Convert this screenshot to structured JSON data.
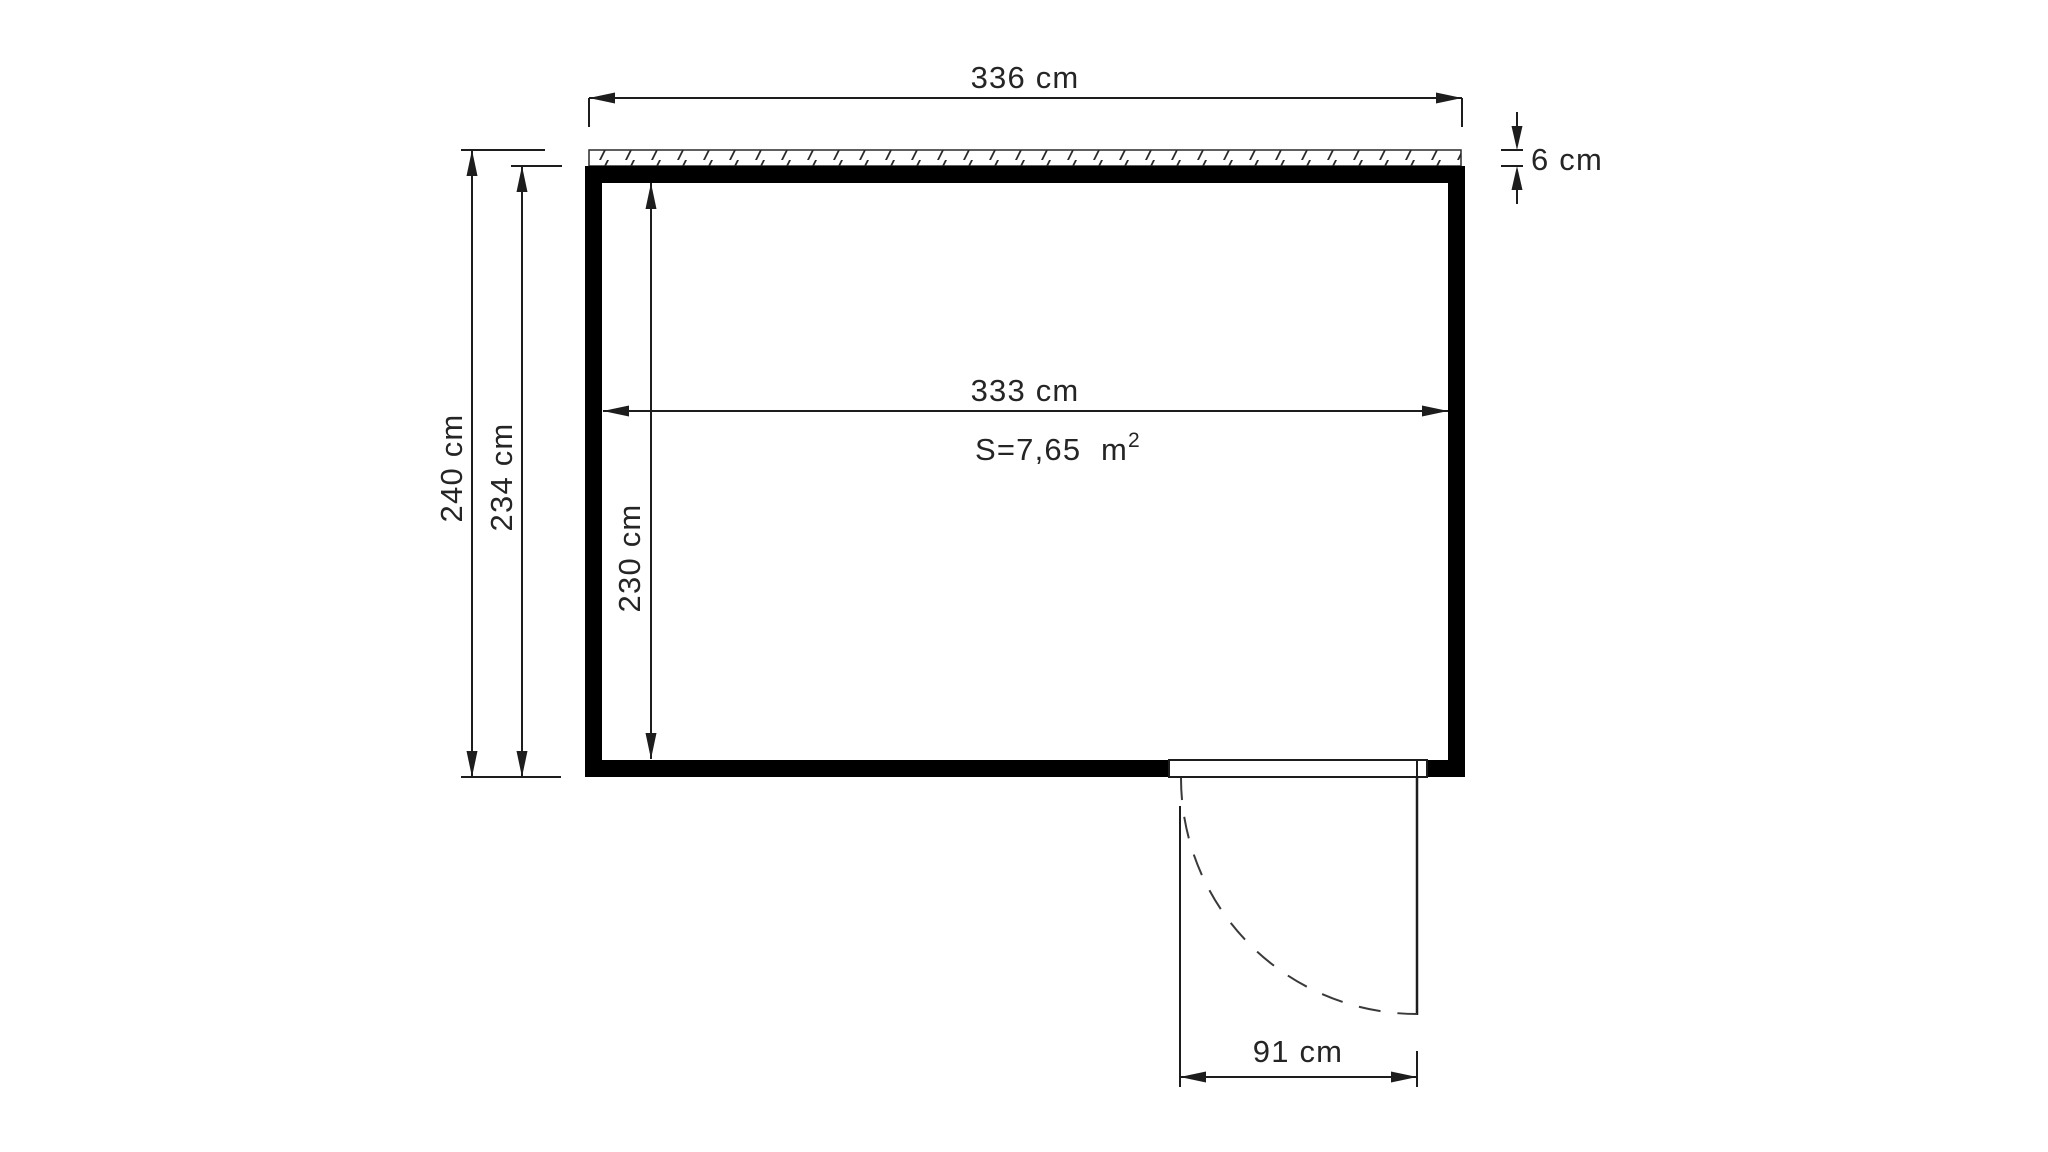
{
  "drawing": {
    "kind": "shed-floor-plan",
    "colors": {
      "background": "#ffffff",
      "line": "#1d1d1d",
      "wall": "#000000",
      "text": "#252525"
    },
    "labels": {
      "outer_width": "336 cm",
      "overhang_thickness": "6 cm",
      "outer_depth": "240 cm",
      "depth_without_overhang": "234 cm",
      "inner_width": "333 cm",
      "inner_depth": "230 cm",
      "door_width": "91 cm",
      "area_main": "S=7,65  m",
      "area_sup": "2"
    }
  }
}
